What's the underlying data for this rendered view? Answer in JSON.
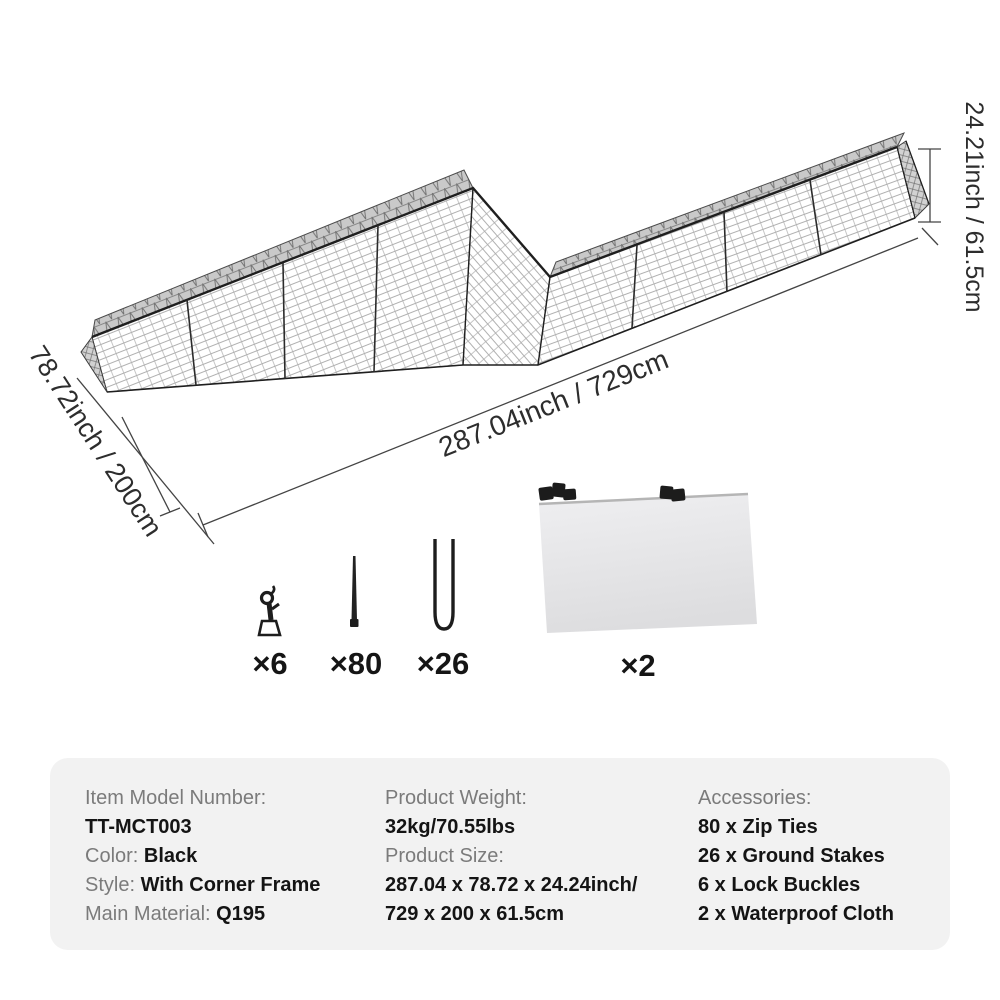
{
  "diagram": {
    "height_label": "24.21inch / 61.5cm",
    "length_label": "287.04inch / 729cm",
    "width_label": "78.72inch / 200cm",
    "structure": "zigzag wire mesh pet run with corner frame",
    "mesh_color": "#9c9c9c",
    "frame_color": "#222222"
  },
  "accessories": {
    "items": [
      {
        "icon": "snap-hook-icon",
        "count_label": "×6"
      },
      {
        "icon": "zip-tie-icon",
        "count_label": "×80"
      },
      {
        "icon": "ground-stake-icon",
        "count_label": "×26"
      },
      {
        "icon": "waterproof-cloth-icon",
        "count_label": "×2"
      }
    ]
  },
  "specs": {
    "columns": [
      {
        "lines": [
          {
            "label": "Item Model Number:",
            "value": ""
          },
          {
            "label": "",
            "value": "TT-MCT003"
          },
          {
            "label": "Color: ",
            "value": "Black"
          },
          {
            "label": "Style: ",
            "value": "With Corner Frame"
          },
          {
            "label": "Main Material: ",
            "value": "Q195"
          }
        ]
      },
      {
        "lines": [
          {
            "label": "Product Weight:",
            "value": ""
          },
          {
            "label": "",
            "value": "32kg/70.55lbs"
          },
          {
            "label": "Product Size:",
            "value": ""
          },
          {
            "label": "",
            "value": "287.04 x 78.72 x 24.24inch/"
          },
          {
            "label": "",
            "value": "729 x 200 x 61.5cm"
          }
        ]
      },
      {
        "lines": [
          {
            "label": "Accessories:",
            "value": ""
          },
          {
            "label": "",
            "value": "80 x Zip Ties"
          },
          {
            "label": "",
            "value": "26 x Ground Stakes"
          },
          {
            "label": "",
            "value": "6 x Lock Buckles"
          },
          {
            "label": "",
            "value": "2 x Waterproof Cloth"
          }
        ]
      }
    ]
  },
  "colors": {
    "page_bg": "#ffffff",
    "panel_bg": "#f2f2f2",
    "label_gray": "#7b7b7b",
    "value_black": "#141414",
    "line_color": "#3c3c3c",
    "roof_gray": "#c9c9c9",
    "cloth_gray": "#e9e9eb"
  }
}
